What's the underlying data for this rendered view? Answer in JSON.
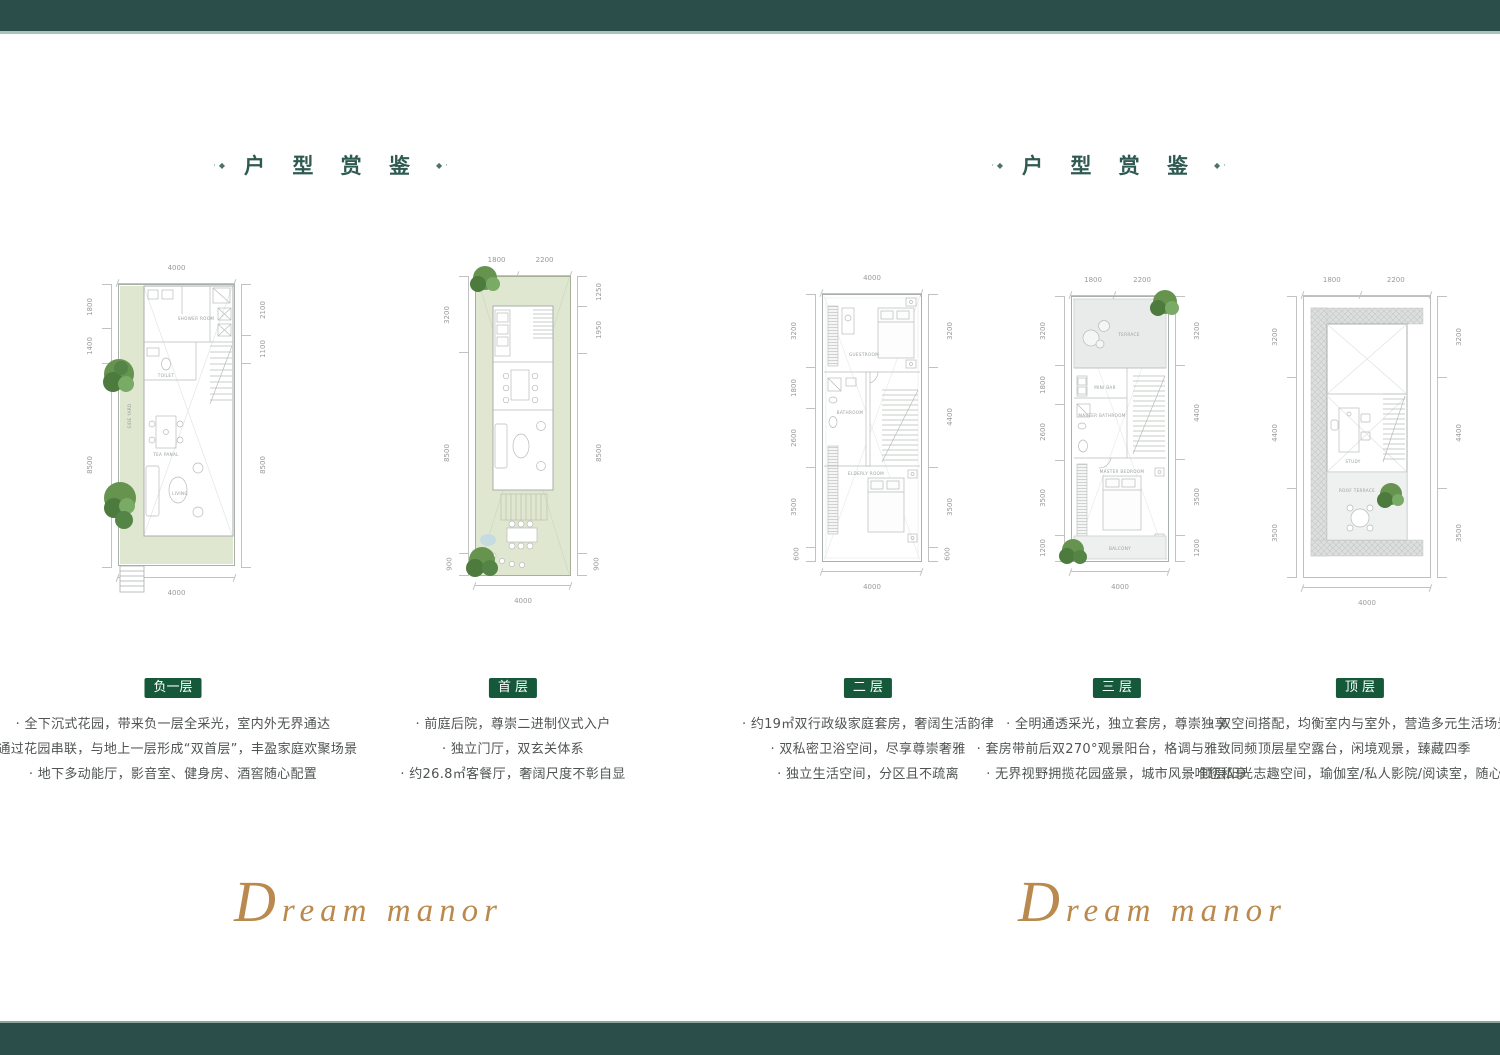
{
  "colors": {
    "teal": "#2b4e4a",
    "sage": "#a9c3b6",
    "badge": "#15593a",
    "title": "#2f5a52",
    "text": "#4f5450",
    "dim": "#9a9a9a",
    "garden": "#dfe7d0",
    "gold": "#b9894d"
  },
  "panels": [
    {
      "title": "户 型 赏 鉴",
      "deco_left": "·◆",
      "deco_right": "◆·",
      "script": "Dream manor"
    },
    {
      "title": "户 型 赏 鉴",
      "deco_left": "·◆",
      "deco_right": "◆·",
      "script": "Dream manor"
    }
  ],
  "floors": [
    {
      "badge": "负一层",
      "bullets": [
        "全下沉式花园，带来负一层全采光，室内外无界通达",
        "通过花园串联，与地上一层形成“双首层”，丰盈家庭欢聚场景",
        "地下多动能厅，影音室、健身房、酒窖随心配置"
      ],
      "plan": {
        "dims_top": [
          "4000"
        ],
        "dims_left": [
          "1800",
          "1400",
          "8500"
        ],
        "dims_right": [
          "2100",
          "1100",
          "8500"
        ],
        "dims_bottom": [
          "4000"
        ],
        "rooms": {
          "shower": "SHOWER ROOM",
          "toilet": "TOILET",
          "side_yard": "SIDE YARD",
          "tea": "TEA PANAL",
          "living": "LIVING"
        }
      }
    },
    {
      "badge": "首 层",
      "bullets": [
        "前庭后院，尊崇二进制仪式入户",
        "独立门厅，双玄关体系",
        "约26.8㎡客餐厅，奢阔尺度不彰自显"
      ],
      "plan": {
        "dims_top": [
          "1800",
          "2200"
        ],
        "dims_left": [
          "3200",
          "8500",
          "900"
        ],
        "dims_right": [
          "1250",
          "1950",
          "8500",
          "900"
        ],
        "dims_bottom": [
          "4000"
        ],
        "rooms": {}
      }
    },
    {
      "badge": "二 层",
      "bullets": [
        "约19㎡双行政级家庭套房，奢阔生活韵律",
        "双私密卫浴空间，尽享尊崇奢雅",
        "独立生活空间，分区且不疏离"
      ],
      "plan": {
        "dims_top": [
          "4000"
        ],
        "dims_left": [
          "3200",
          "1800",
          "2600",
          "3500",
          "600"
        ],
        "dims_right": [
          "3200",
          "4400",
          "3500",
          "600"
        ],
        "dims_bottom": [
          "4000"
        ],
        "rooms": {
          "guest": "GUESTROOM",
          "bath": "BATHROOM",
          "elder": "ELDERLY ROOM"
        }
      }
    },
    {
      "badge": "三 层",
      "bullets": [
        "全明通透采光，独立套房，尊崇独享",
        "套房带前后双270°观景阳台，格调与雅致同频",
        "无界视野拥揽花园盛景，城市风景唯您私享"
      ],
      "plan": {
        "dims_top": [
          "1800",
          "2200"
        ],
        "dims_left": [
          "3200",
          "1800",
          "2600",
          "3500",
          "1200"
        ],
        "dims_right": [
          "3200",
          "4400",
          "3500",
          "1200"
        ],
        "dims_bottom": [
          "4000"
        ],
        "rooms": {
          "terrace": "TERRACE",
          "minibar": "MINI BAR",
          "mbath": "MASTER BATHROOM",
          "mbed": "MASTER BEDROOM",
          "balcony": "BALCONY"
        }
      }
    },
    {
      "badge": "顶 层",
      "bullets": [
        "双空间搭配，均衡室内与室外，营造多元生活场景",
        "顶层星空露台，闲境观景，臻藏四季",
        "顶层阳光志趣空间，瑜伽室/私人影院/阅读室，随心而定"
      ],
      "plan": {
        "dims_top": [
          "1800",
          "2200"
        ],
        "dims_left": [
          "3200",
          "4400",
          "3500"
        ],
        "dims_right": [
          "3200",
          "4400",
          "3500"
        ],
        "dims_bottom": [
          "4000"
        ],
        "rooms": {
          "study": "STUDY",
          "roof_terrace": "ROOF TERRACE"
        }
      }
    }
  ]
}
